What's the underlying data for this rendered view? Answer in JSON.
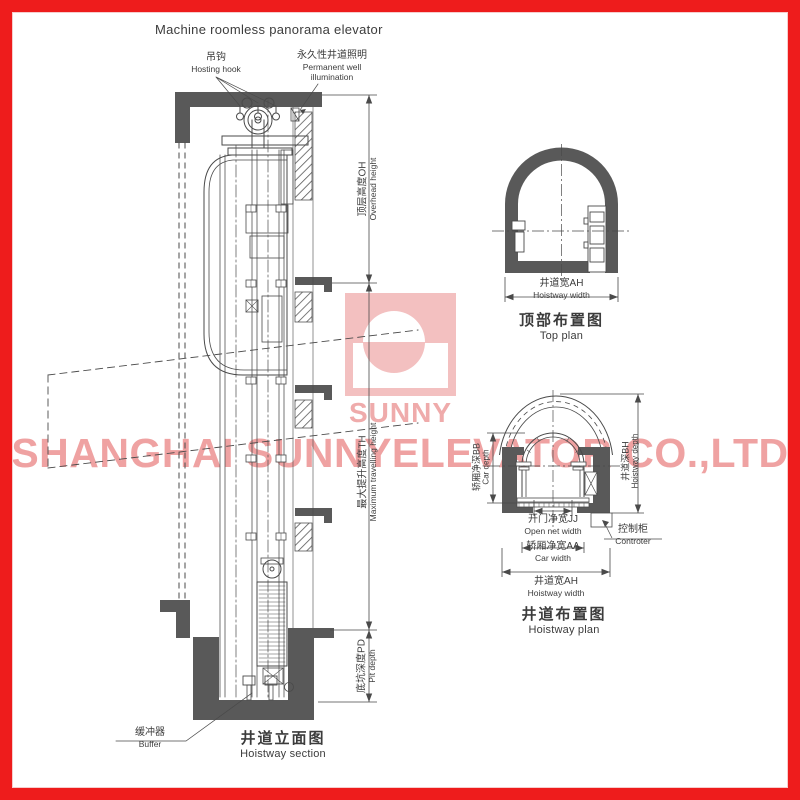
{
  "page": {
    "title": "Machine roomless panorama elevator"
  },
  "watermark": {
    "logo_text": "SUNNY",
    "company": "SHANGHAI SUNNYELEVATOR CO.,LTD"
  },
  "colors": {
    "frame_red": "#ee1c1c",
    "line_gray": "#4a4a4a",
    "wall_gray": "#595959",
    "watermark_pink": "#efa2a2"
  },
  "section": {
    "labels": {
      "hook": {
        "zh": "吊钩",
        "en": "Hosting hook"
      },
      "illumination": {
        "zh": "永久性井道照明",
        "en1": "Permanent well",
        "en2": "illumination"
      },
      "overhead": {
        "zh": "顶层高度OH",
        "en": "Overhead height"
      },
      "travel": {
        "zh": "最大提升高度TH",
        "en": "Maximum travelling height"
      },
      "pit": {
        "zh": "底坑深度PD",
        "en": "Pit depth"
      },
      "buffer": {
        "zh": "缓冲器",
        "en": "Buffer"
      }
    },
    "title": {
      "zh": "井道立面图",
      "en": "Hoistway section"
    }
  },
  "top_plan": {
    "hoistway_width": {
      "zh": "井道宽AH",
      "en": "Hoistway width"
    },
    "title": {
      "zh": "顶部布置图",
      "en": "Top plan"
    }
  },
  "hoistway_plan": {
    "car_depth": {
      "zh": "轿厢净深BB",
      "en": "Car depth"
    },
    "hoistway_depth": {
      "zh": "井道深BH",
      "en": "Hoistway depth"
    },
    "open_width": {
      "zh": "开门净宽JJ",
      "en": "Open net width"
    },
    "car_width": {
      "zh": "轿厢净宽AA",
      "en": "Car width"
    },
    "hoistway_width": {
      "zh": "井道宽AH",
      "en": "Hoistway width"
    },
    "controller": {
      "zh": "控制柜",
      "en": "Controter"
    },
    "title": {
      "zh": "井道布置图",
      "en": "Hoistway plan"
    }
  }
}
